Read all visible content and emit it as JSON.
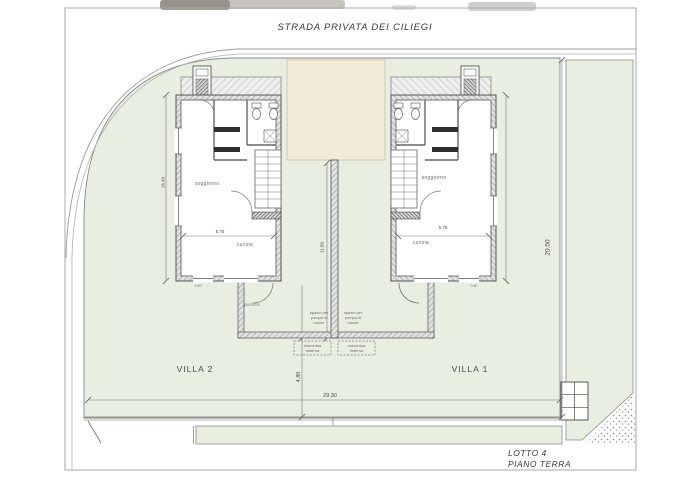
{
  "page": {
    "title": "STRADA PRIVATA DEI CILIEGI"
  },
  "villas": {
    "left_label": "VILLA 2",
    "right_label": "VILLA 1"
  },
  "annotations": {
    "lot": "LOTTO 4",
    "floor": "PIANO TERRA",
    "portico": "portico"
  },
  "rooms": {
    "living": "soggiorno",
    "kitchen": "cucina",
    "heat_pump": "spazio per pompa di calore",
    "outdoor_unit": "macchina esterna"
  },
  "dimensions": {
    "lot_depth": "20.50",
    "lot_width": "29.30",
    "rear": "4.80",
    "villa_depth": "16.40",
    "villa_width": "5.75",
    "center_depth": "11.50",
    "window": "0.90"
  },
  "colors": {
    "lot_green": "#e8efe1",
    "court_beige": "#f3ebd8",
    "paper": "#ffffff",
    "line_gray": "#8a8a8a"
  }
}
